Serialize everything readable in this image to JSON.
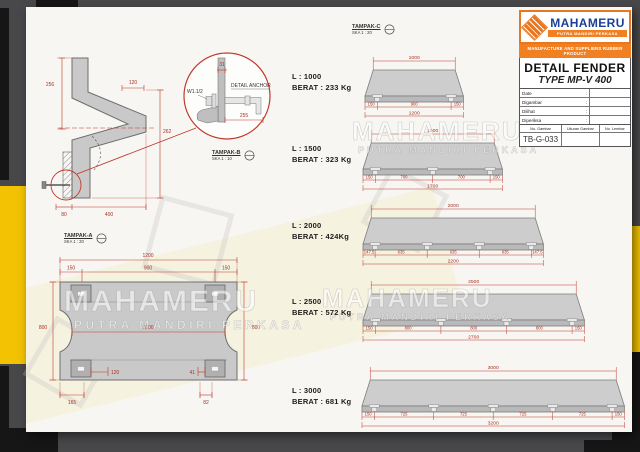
{
  "title_block": {
    "brand": "MAHAMERU",
    "brand_sub": "PUTRA MANDIRI PERKASA",
    "tagline": "MANUFACTURE AND SUPPLIERS RUBBER PRODUCT",
    "title": "DETAIL FENDER",
    "subtitle": "TYPE MP-V 400",
    "field_labels": [
      "Date",
      "Digambar",
      "Dilihat",
      "Diperiksa"
    ],
    "footer_headers": [
      "No. Gambar",
      "Ukuran Gambar",
      "No. Lembar"
    ],
    "drawing_number": "TB-G-033"
  },
  "watermark": {
    "line1": "MAHAMERU",
    "line2": "PUTRA MANDIRI PERKASA"
  },
  "section_view": {
    "view_label": "TAMPAK-B",
    "view_scale": "SKA 1 : 10",
    "dim_256": "256",
    "dim_120": "120",
    "dim_262": "262",
    "dim_80": "80",
    "dim_400": "400",
    "detail_title": "DETAIL ANCHOR",
    "bolt_label": "W1.1/2",
    "dim_31": "31",
    "dim_255": "255"
  },
  "plan_view": {
    "view_label": "TAMPAK-A",
    "view_scale": "SKA 1 : 20",
    "dim_overall": "1200",
    "dim_edge_left": "150",
    "dim_center": "900",
    "dim_edge_right": "150",
    "dim_mid": "1000",
    "dim_height_left": "800",
    "dim_height_right": "800",
    "dim_slot": "120",
    "dim_slot2": "41",
    "dim_offset_left": "165",
    "dim_offset_right": "82"
  },
  "top_view_label": {
    "view_label": "TAMPAK-C",
    "view_scale": "SKA 1 : 20"
  },
  "fenders": [
    {
      "length_label": "L : 1000",
      "weight_label": "BERAT : 233 Kg",
      "top_mm": 1000,
      "overall_mm": 1200,
      "bottom_mm": [
        150,
        900,
        150
      ]
    },
    {
      "length_label": "L : 1500",
      "weight_label": "BERAT : 323 Kg",
      "top_mm": 1500,
      "overall_mm": 1700,
      "bottom_mm": [
        150,
        700,
        700,
        150
      ]
    },
    {
      "length_label": "L : 2000",
      "weight_label": "BERAT : 424Kg",
      "top_mm": 2000,
      "overall_mm": 2200,
      "bottom_mm": [
        147.5,
        635,
        635,
        635,
        147.5
      ]
    },
    {
      "length_label": "L : 2500",
      "weight_label": "BERAT : 572 Kg",
      "top_mm": 2500,
      "overall_mm": 2700,
      "bottom_mm": [
        150,
        800,
        800,
        800,
        150
      ]
    },
    {
      "length_label": "L : 3000",
      "weight_label": "BERAT : 681 Kg",
      "top_mm": 3000,
      "overall_mm": 3200,
      "bottom_mm": [
        150,
        725,
        725,
        725,
        725,
        150
      ]
    }
  ],
  "colors": {
    "dim": "#c0392b",
    "dim_text": "#a93226",
    "body_gray": "#cdcdcd",
    "face_gray": "#b9b9b9",
    "brand_orange": "#f08021",
    "brand_blue": "#1b3f94",
    "accent_yellow": "#f3c203",
    "accent_black": "#161616"
  }
}
